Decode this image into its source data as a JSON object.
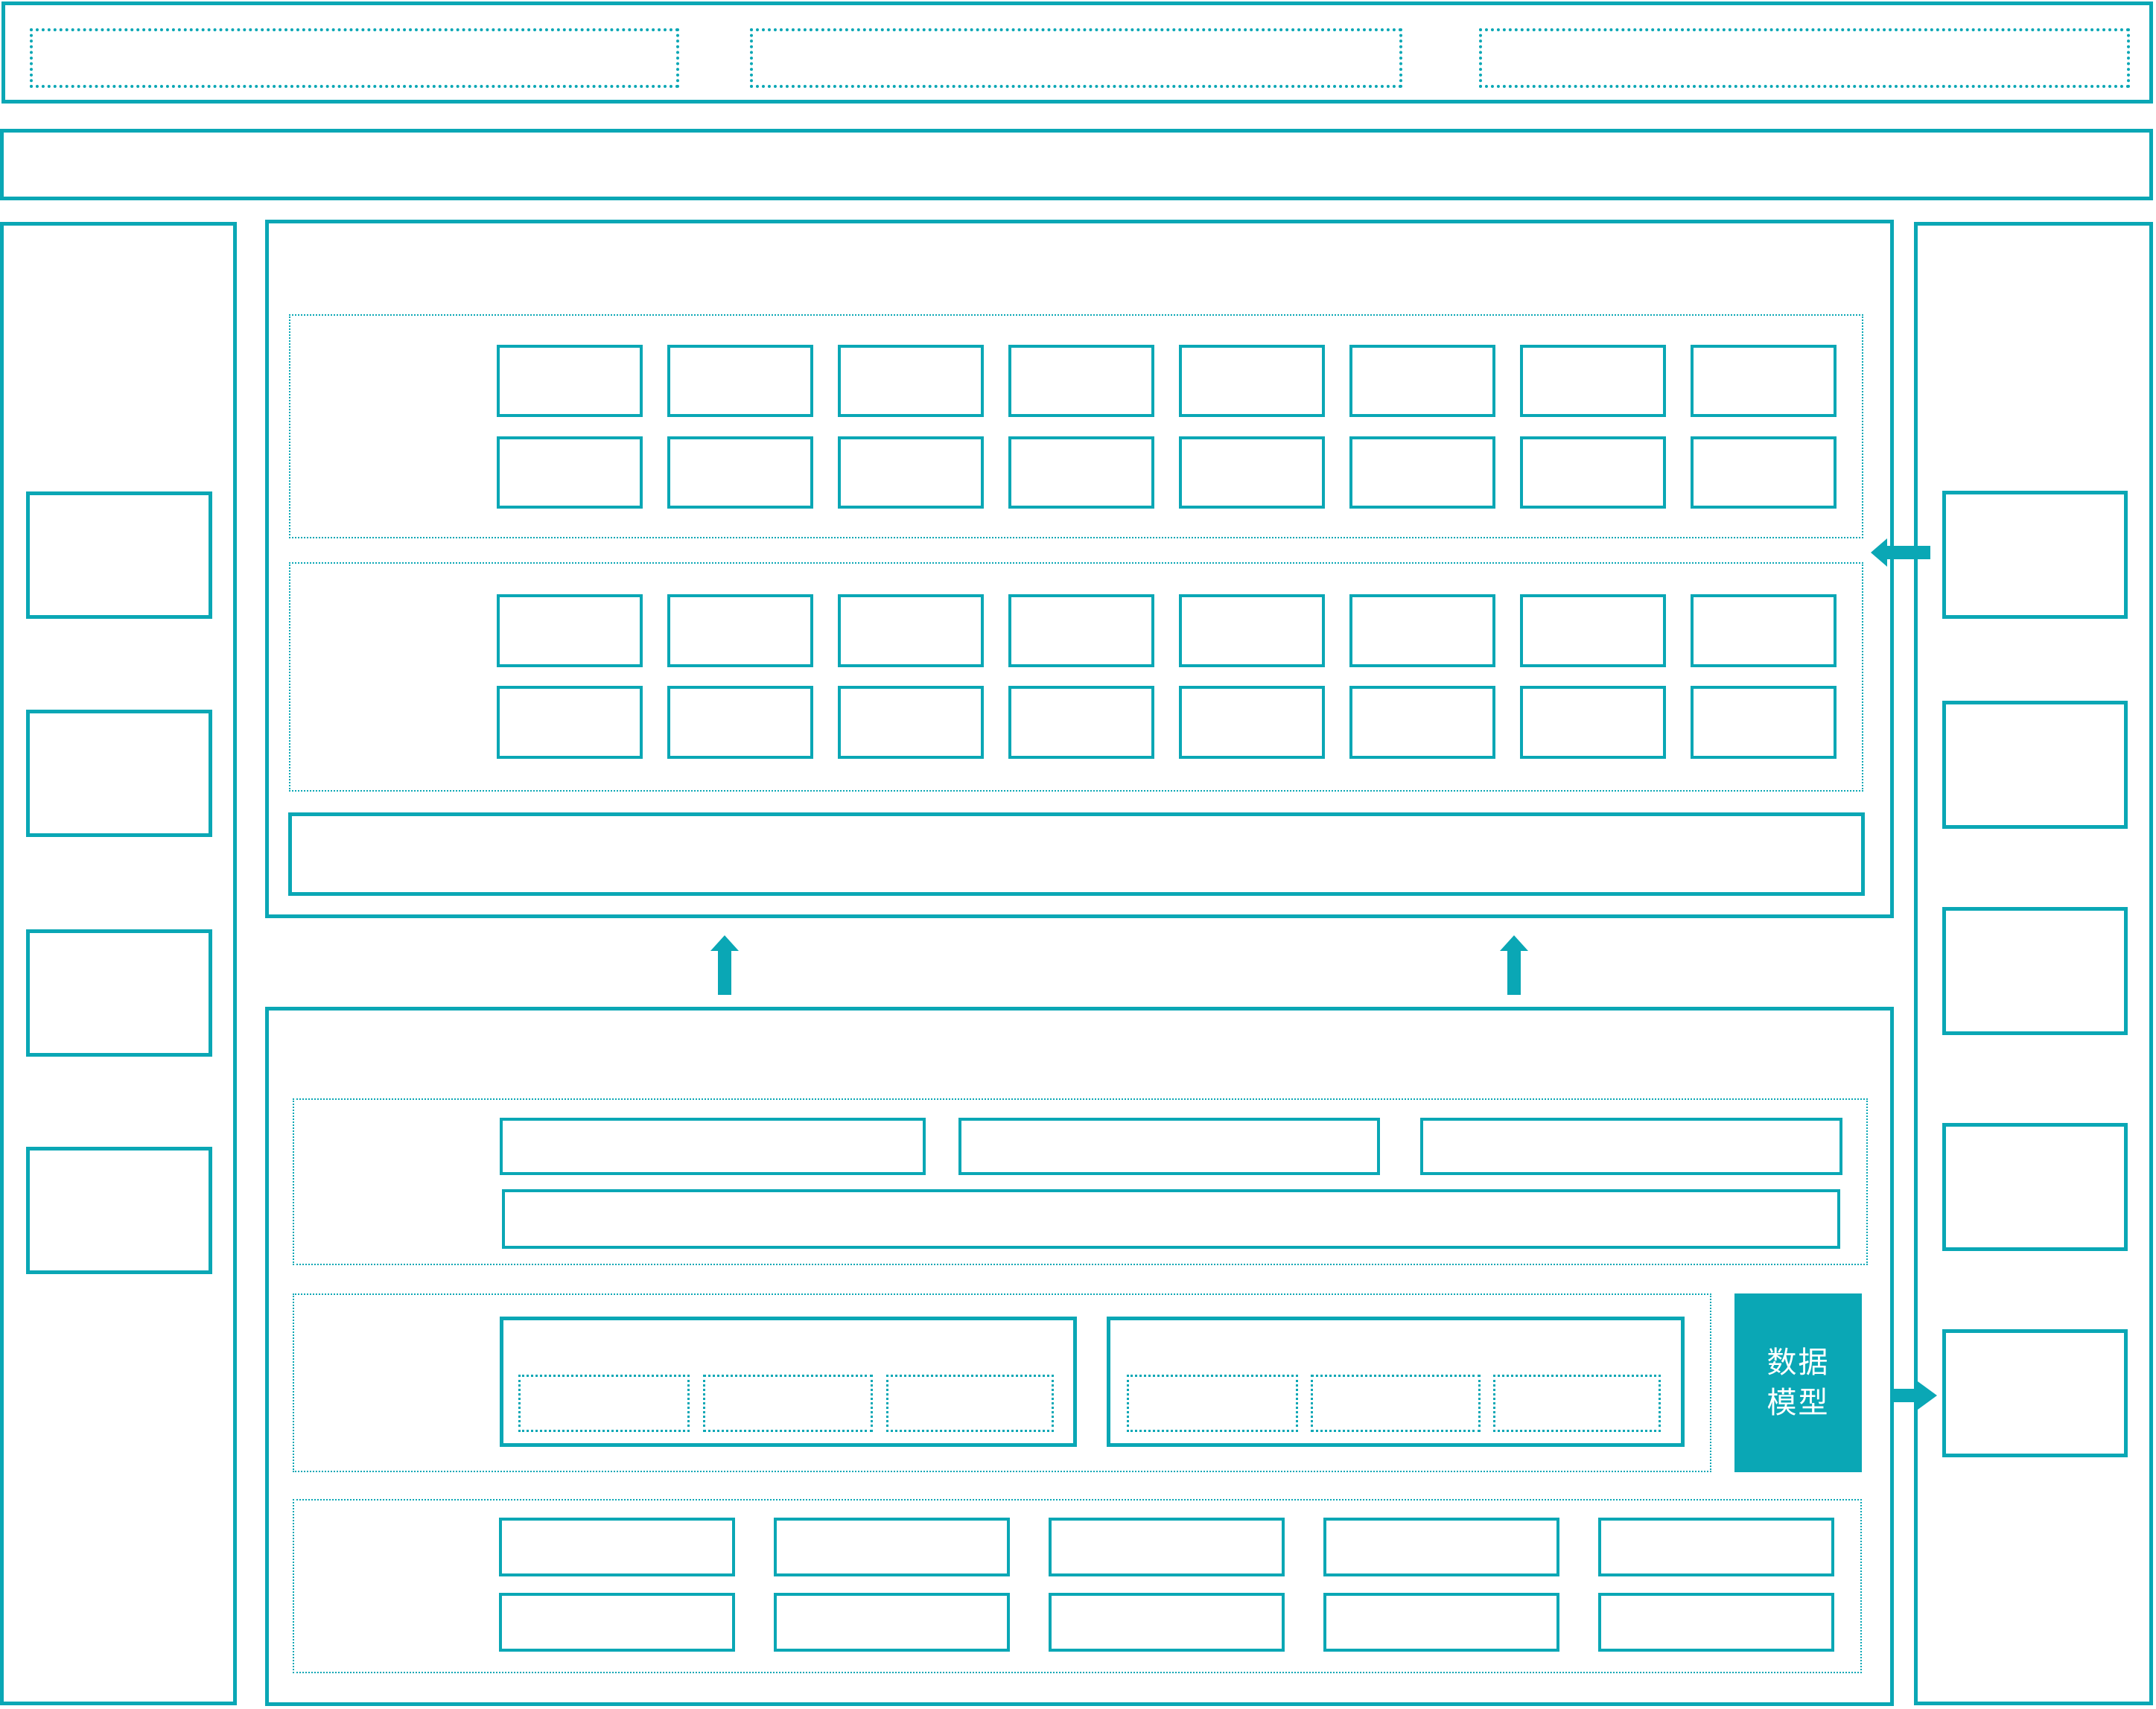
{
  "colors": {
    "accent": "#0AA7B5",
    "filled_box_background": "#0AA7B5",
    "filled_box_text": "#FFFFFF",
    "background": "#FFFFFF"
  },
  "diagram": {
    "data_model_box": {
      "label": "数据模型"
    },
    "arrows": [
      {
        "name": "up-arrow-left"
      },
      {
        "name": "up-arrow-right"
      },
      {
        "name": "left-arrow-into-top-panel"
      },
      {
        "name": "right-arrow-into-sidebar"
      }
    ]
  }
}
